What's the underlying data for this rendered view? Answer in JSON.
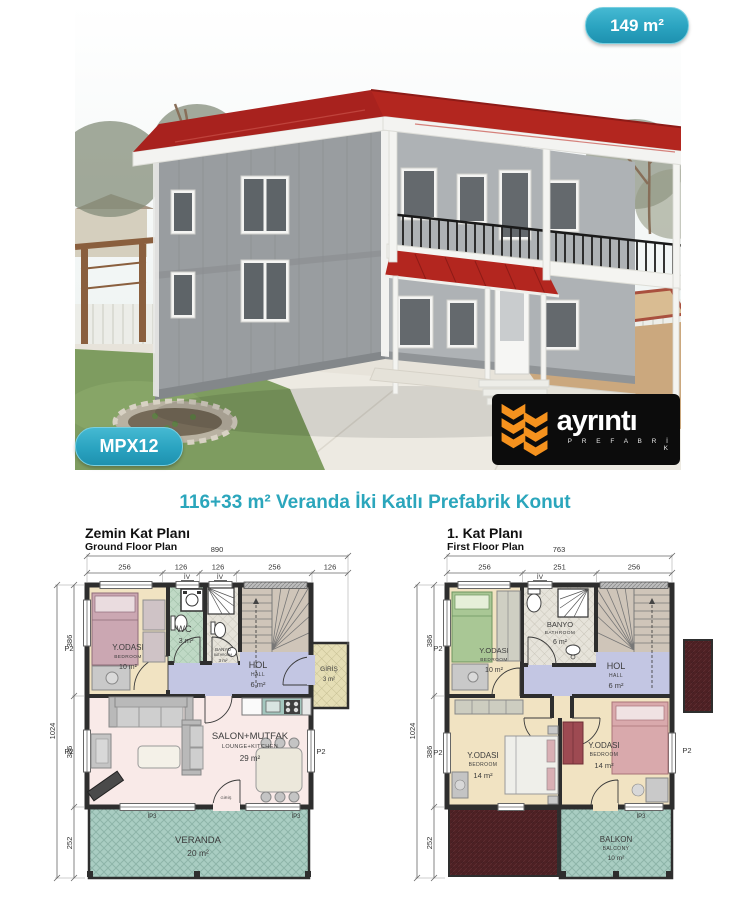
{
  "flyer": {
    "area_badge": "149 m²",
    "model_badge": "MPX12",
    "logo": {
      "brand": "ayrıntı",
      "subtitle": "P R E F A B R İ K"
    },
    "title": "116+33 m² Veranda İki Katlı Prefabrik Konut"
  },
  "colors": {
    "accent_teal": "#2BA6BC",
    "badge_teal": "#2AA3C0",
    "logo_orange": "#F5921E",
    "roof_red": "#A8221E",
    "veranda_hatch": "#A9CDC2",
    "hall_lavender": "#C3C6E3",
    "bedroom_beige": "#F1E3C2",
    "salon_pink": "#F9EAE8",
    "roof_plan_maroon": "#4E2124"
  },
  "ground_plan": {
    "title_tr": "Zemin Kat Planı",
    "title_en": "Ground Floor Plan",
    "total_width": "890",
    "width_segments": [
      "256",
      "126",
      "126",
      "256",
      "126"
    ],
    "total_height": "1024",
    "height_segments": [
      "386",
      "386",
      "252"
    ],
    "labels": {
      "p2": "P2",
      "ip3": "İP3",
      "iv": "İV"
    },
    "door_label": "GİRİŞ",
    "rooms": {
      "bedroom": {
        "tr": "Y.ODASI",
        "en": "BEDROOM",
        "area": "10 m²"
      },
      "wc": {
        "tr": "WC",
        "area": "3 m²"
      },
      "bathroom": {
        "tr": "BANYO",
        "en": "BATHROOM",
        "area": "3 m²"
      },
      "hall": {
        "tr": "HOL",
        "en": "HALL",
        "area": "6 m²"
      },
      "entrance": {
        "tr": "GİRİŞ",
        "area": "3 m²"
      },
      "lounge": {
        "tr": "SALON+MUTFAK",
        "en": "LOUNGE+KITCHEN",
        "area": "29 m²"
      },
      "veranda": {
        "tr": "VERANDA",
        "area": "20 m²"
      }
    }
  },
  "first_plan": {
    "title_tr": "1. Kat Planı",
    "title_en": "First Floor Plan",
    "total_width": "763",
    "width_segments": [
      "256",
      "251",
      "256"
    ],
    "total_height": "1024",
    "height_segments": [
      "386",
      "386",
      "252"
    ],
    "labels": {
      "p2": "P2",
      "ip3": "İP3",
      "iv": "İV"
    },
    "rooms": {
      "bedroom_small": {
        "tr": "Y.ODASI",
        "en": "BEDROOM",
        "area": "10 m²"
      },
      "bathroom": {
        "tr": "BANYO",
        "en": "BATHROOM",
        "area": "6 m²"
      },
      "hall": {
        "tr": "HOL",
        "en": "HALL",
        "area": "6 m²"
      },
      "bedroom_left": {
        "tr": "Y.ODASI",
        "en": "BEDROOM",
        "area": "14 m²"
      },
      "bedroom_right": {
        "tr": "Y.ODASI",
        "en": "BEDROOM",
        "area": "14 m²"
      },
      "balcony": {
        "tr": "BALKON",
        "en": "BALCONY",
        "area": "10 m²"
      }
    }
  }
}
